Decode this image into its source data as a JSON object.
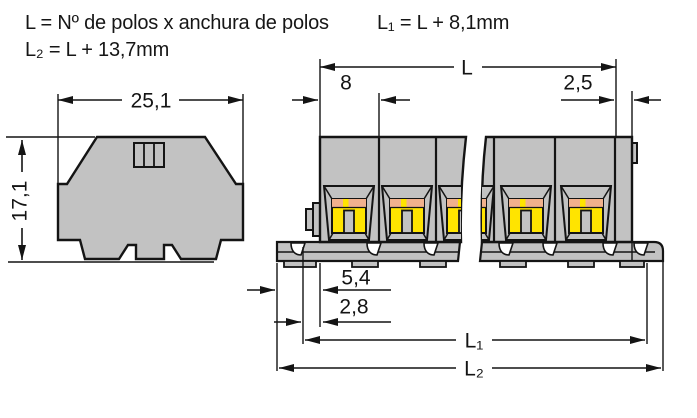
{
  "header": {
    "formula_l": "L = Nº de polos x anchura de polos",
    "formula_l1": "L₁ = L + 8,1mm",
    "formula_l2": "L₂ = L + 13,7mm"
  },
  "front_view": {
    "width_mm": "25,1",
    "height_mm": "17,1"
  },
  "side_view": {
    "total_length": "L",
    "pole_pitch_mm": "8",
    "end_plate_mm": "2,5",
    "rail_offset_mm": "5,4",
    "rail_offset_inner_mm": "2,8",
    "length_l1": "L₁",
    "length_l2": "L₂"
  },
  "colors": {
    "body_gray": "#C2C2C2",
    "terminal_yellow": "#FFE400",
    "clamp_salmon": "#F1B18D",
    "line_black": "#141414",
    "background": "#FFFFFF"
  }
}
